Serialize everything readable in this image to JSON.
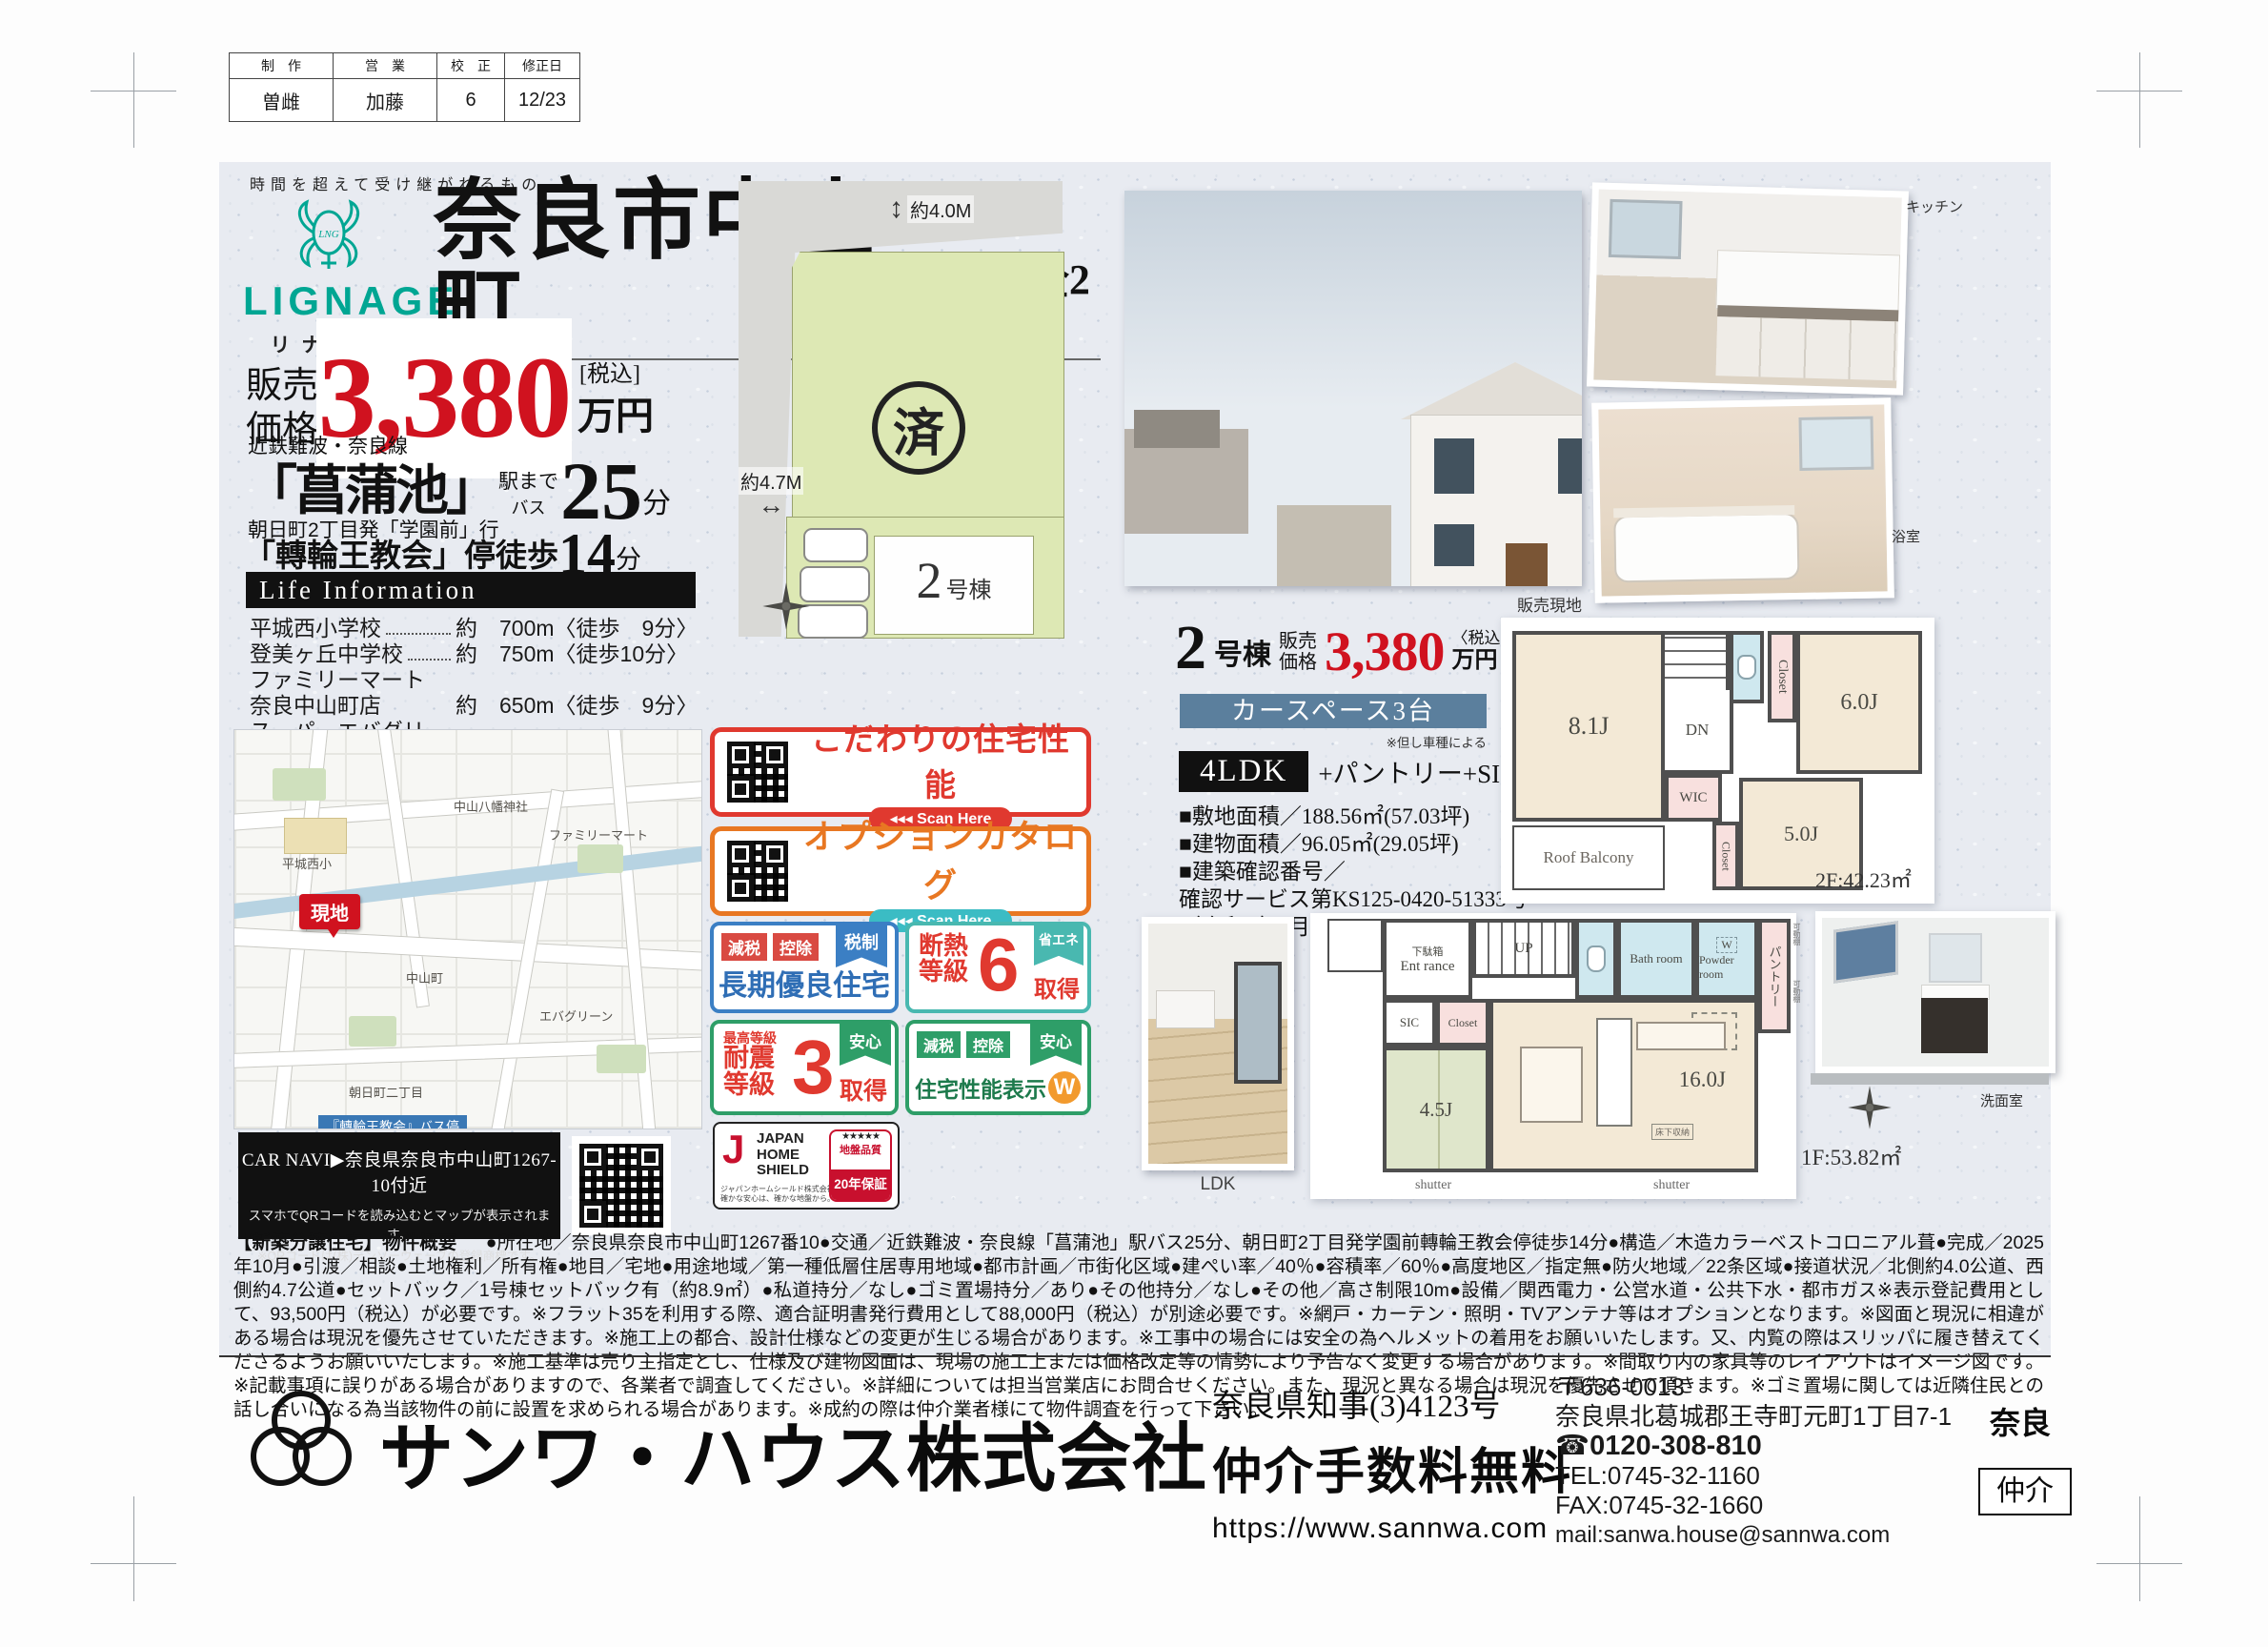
{
  "proof": {
    "headers": [
      "制　作",
      "営　業",
      "校　正",
      "修正日"
    ],
    "values": [
      "曽雌",
      "加藤",
      "6",
      "12/23"
    ]
  },
  "brand": {
    "tagline": "時間を超えて受け継がれるもの",
    "logo": "LIGNAGE",
    "kana": "リナージュ"
  },
  "title": {
    "main": "奈良市中山町",
    "sub": "第3期 全2棟"
  },
  "price": {
    "label1": "販売",
    "label2": "価格",
    "amount": "3,380",
    "tax": "[税込]",
    "unit": "万円"
  },
  "access": {
    "rail": "近鉄難波・奈良線",
    "station": "「菖蒲池」",
    "to_station": "駅まで",
    "mode": "バス",
    "minutes": "25",
    "min_unit": "分",
    "bus": "朝日町2丁目発「学園前」行",
    "stop": "「轉輪王教会」停徒歩",
    "stop_minutes": "14",
    "stop_unit": "分"
  },
  "life": {
    "title": "Life Information",
    "items": [
      {
        "name": "平城西小学校",
        "dist": "約　700m〈徒歩　9分〉"
      },
      {
        "name": "登美ヶ丘中学校",
        "dist": "約　750m〈徒歩10分〉"
      },
      {
        "name": "ファミリーマート奈良中山町店",
        "dist": "約　650m〈徒歩　9分〉"
      },
      {
        "name": "スーパーエバグリーン押熊店",
        "dist": "約　850m〈徒歩11分〉"
      },
      {
        "name": "奈良朝日郵便局",
        "dist": "約1,000m〈徒歩13分〉"
      },
      {
        "name": "小山医院",
        "dist": "約1,000m〈徒歩13分〉"
      }
    ]
  },
  "map": {
    "genchi": "現地",
    "busstop": "『轉輪王教会』バス停",
    "labels": [
      "平城西小",
      "中山八幡神社",
      "ファミリーマート",
      "エバグリーン",
      "中山町",
      "朝日町二丁目"
    ],
    "carnavi": "CAR NAVI▶奈良県奈良市中山町1267-10付近",
    "note1": "スマホでQRコードを読み込むとマップが表示されます。",
    "note2": "※QRコードは(株)デンソーウェーブの登録商標です。"
  },
  "siteplan": {
    "dim_top": "約4.0M",
    "dim_left": "約4.7M",
    "sold": "済",
    "lot_num": "2",
    "lot_suffix": "号棟"
  },
  "qr1": {
    "title": "こだわりの住宅性能",
    "scan": "◂◂◂ Scan Here"
  },
  "qr2": {
    "title": "オプションカタログ",
    "scan": "◂◂◂ Scan Here"
  },
  "badge_choki": {
    "t1": "減税",
    "t2": "控除",
    "ribbon": "税制",
    "main": "長期優良住宅"
  },
  "badge_dannetsu": {
    "l1": "断熱",
    "l2": "等級",
    "num": "6",
    "ribbon": "省エネ",
    "get": "取得"
  },
  "badge_taishin": {
    "top": "最高等級",
    "l1": "耐震",
    "l2": "等級",
    "num": "3",
    "ribbon": "安心",
    "get": "取得"
  },
  "badge_seinou": {
    "t1": "減税",
    "t2": "控除",
    "ribbon": "安心",
    "main": "住宅性能表示",
    "w": "W"
  },
  "jhs": {
    "j": "J",
    "name1": "JAPAN",
    "name2": "HOME",
    "name3": "SHIELD",
    "sub1": "ジャパンホームシールド株式会社",
    "sub2": "確かな安心は、確かな地盤から。",
    "stars": "★★★★★",
    "quality": "地盤品質",
    "warranty": "20年保証"
  },
  "unit": {
    "num": "2",
    "suffix": "号棟",
    "price_label1": "販売",
    "price_label2": "価格",
    "amount": "3,380",
    "tax": "〈税込〉",
    "unit": "万円",
    "car": "カースペース3台",
    "car_note": "※但し車種による",
    "plan": "4LDK",
    "plan_plus": "+パントリー+SIC",
    "spec1": "■敷地面積／188.56㎡(57.03坪)",
    "spec2": "■建物面積／96.05㎡(29.05坪)",
    "spec3": "■建築確認番号／",
    "spec4": "確認サービス第KS125-0420-51333号",
    "spec5": "（令和7年5月16日）"
  },
  "plan2f": {
    "r1": "8.1J",
    "r2": "WIC",
    "r3": "DN",
    "r4": "Closet",
    "r5": "6.0J",
    "r6": "5.0J",
    "r7": "Closet",
    "r8": "Roof Balcony",
    "area": "2F:42.23㎡"
  },
  "plan1f": {
    "r1": "下駄箱",
    "r2": "Ent rance",
    "r3": "UP",
    "r4": "Bath room",
    "r5": "W",
    "r6": "Powder room",
    "r7": "パントリー",
    "r8": "可動棚",
    "r9": "可動棚",
    "r10": "SIC",
    "r11": "Closet",
    "r12": "4.5J",
    "r13": "16.0J",
    "r14": "R",
    "r15": "床下収納",
    "sh1": "shutter",
    "sh2": "shutter",
    "area": "1F:53.82㎡"
  },
  "photos": {
    "exterior": "販売現地",
    "kitchen": "キッチン",
    "bath": "浴室",
    "ldk": "LDK",
    "washroom": "洗面室"
  },
  "legal": {
    "heading": "【新築分譲住宅】物件概要",
    "text": "●所在地／奈良県奈良市中山町1267番10●交通／近鉄難波・奈良線「菖蒲池」駅バス25分、朝日町2丁目発学園前轉輪王教会停徒歩14分●構造／木造カラーベストコロニアル葺●完成／2025年10月●引渡／相談●土地権利／所有権●地目／宅地●用途地域／第一種低層住居専用地域●都市計画／市街化区域●建ぺい率／40％●容積率／60％●高度地区／指定無●防火地域／22条区域●接道状況／北側約4.0公道、西側約4.7公道●セットバック／1号棟セットバック有（約8.9㎡）●私道持分／なし●ゴミ置場持分／あり●その他持分／なし●その他／高さ制限10m●設備／関西電力・公営水道・公共下水・都市ガス※表示登記費用として、93,500円（税込）が必要です。※フラット35を利用する際、適合証明書発行費用として88,000円（税込）が別途必要です。※網戸・カーテン・照明・TVアンテナ等はオプションとなります。※図面と現況に相違がある場合は現況を優先させていただきます。※施工上の都合、設計仕様などの変更が生じる場合があります。※工事中の場合には安全の為ヘルメットの着用をお願いいたします。又、内覧の際はスリッパに履き替えてくださるようお願いいたします。※施工基準は売り主指定とし、仕様及び建物図面は、現場の施工上または価格改定等の情勢により予告なく変更する場合があります。※間取り内の家具等のレイアウトはイメージ図です。※記載事項に誤りがある場合がありますので、各業者で調査してください。※詳細については担当営業店にお問合せください。また、現況と異なる場合は現況を優先させて頂きます。※ゴミ置場に関しては近隣住民との話し合いになる為当該物件の前に設置を求められる場合があります。※成約の際は仲介業者様にて物件調査を行って下さい。"
  },
  "footer": {
    "company": "サンワ・ハウス株式会社",
    "license": "奈良県知事(3)4123号",
    "fee": "仲介手数料無料",
    "url": "https://www.sannwa.com",
    "zip": "〒636-0013",
    "address": "奈良県北葛城郡王寺町元町1丁目7-1",
    "freedial": "☎0120-308-810",
    "tel": "TEL:0745-32-1160",
    "fax": "FAX:0745-32-1660",
    "mail": "mail:sanwa.house@sannwa.com",
    "pref": "奈良",
    "role": "仲介"
  }
}
